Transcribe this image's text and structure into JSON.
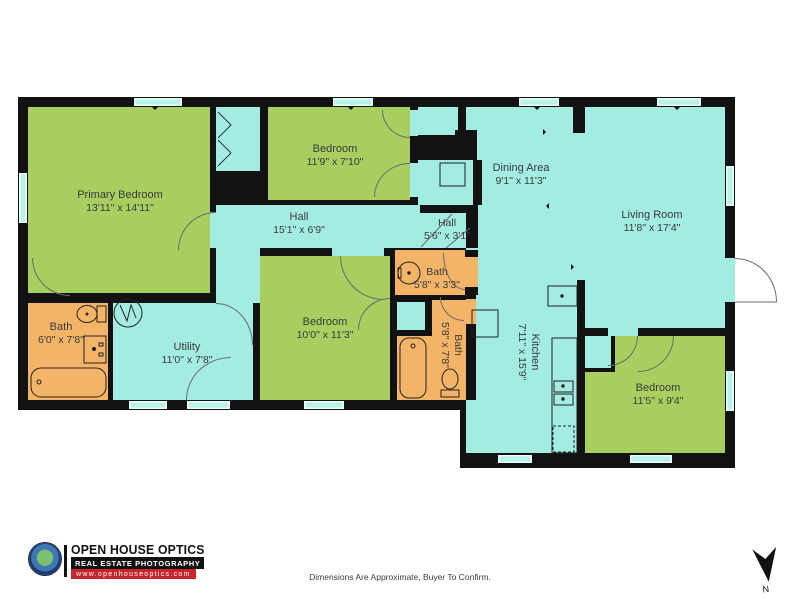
{
  "rooms": [
    {
      "name": "Primary Bedroom",
      "dims": "13'11\" x 14'11\""
    },
    {
      "name": "Bedroom",
      "dims": "11'9\" x 7'10\""
    },
    {
      "name": "Hall",
      "dims": "15'1\" x 6'9\""
    },
    {
      "name": "Hall",
      "dims": "5'6\" x 3'1\""
    },
    {
      "name": "Dining Area",
      "dims": "9'1\" x 11'3\""
    },
    {
      "name": "Living Room",
      "dims": "11'8\" x 17'4\""
    },
    {
      "name": "Bath",
      "dims": "6'0\" x 7'8\""
    },
    {
      "name": "Utility",
      "dims": "11'0\" x 7'8\""
    },
    {
      "name": "Bedroom",
      "dims": "10'0\" x 11'3\""
    },
    {
      "name": "Bath",
      "dims": "5'8\" x 3'3\""
    },
    {
      "name": "Bath",
      "dims": "5'8\" x 7'8\""
    },
    {
      "name": "Kitchen",
      "dims": "7'11\" x 15'9\""
    },
    {
      "name": "Bedroom",
      "dims": "11'5\" x 9'4\""
    }
  ],
  "branding": {
    "company": "OPEN HOUSE OPTICS",
    "tagline": "REAL ESTATE PHOTOGRAPHY",
    "website": "www.openhouseoptics.com"
  },
  "footer": {
    "disclaimer": "Dimensions Are Approximate, Buyer To Confirm."
  },
  "compass": {
    "label": "N"
  },
  "colors": {
    "bedroom_green": "#a8ce60",
    "living_cyan": "#a3ece1",
    "bath_orange": "#f3b467",
    "wall_black": "#121212",
    "brand_red": "#c9252b",
    "brand_navy": "#1d3a67"
  }
}
